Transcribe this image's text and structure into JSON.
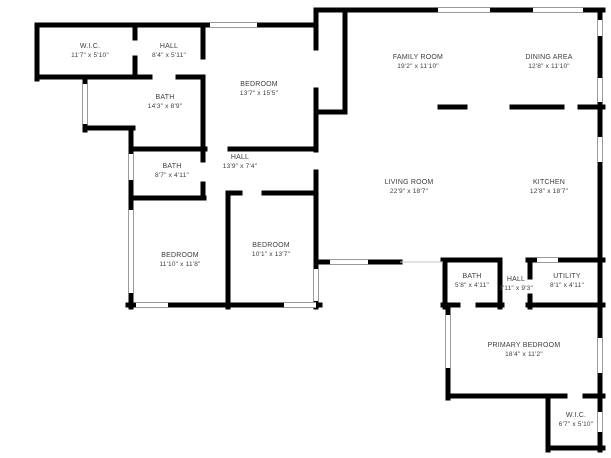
{
  "canvas": {
    "width": 611,
    "height": 458,
    "background": "#ffffff",
    "wall_color": "#000000",
    "window_edge_color": "#9a9a9a",
    "opening_color": "#c8c8c8",
    "text_color": "#3d3d3d",
    "wall_thickness": 5
  },
  "rooms": [
    {
      "id": "wic-top",
      "name": "W.I.C.",
      "dims": "11'7\" x 5'10\"",
      "cx": 90,
      "cy": 48
    },
    {
      "id": "hall-top",
      "name": "HALL",
      "dims": "8'4\" x 5'11\"",
      "cx": 169,
      "cy": 48
    },
    {
      "id": "bath-large",
      "name": "BATH",
      "dims": "14'3\" x 8'9\"",
      "cx": 165,
      "cy": 99
    },
    {
      "id": "bedroom-top",
      "name": "BEDROOM",
      "dims": "13'7\" x 15'5\"",
      "cx": 259,
      "cy": 86
    },
    {
      "id": "family-room",
      "name": "FAMILY ROOM",
      "dims": "19'2\" x 11'10\"",
      "cx": 418,
      "cy": 59
    },
    {
      "id": "dining-area",
      "name": "DINING AREA",
      "dims": "12'8\" x 11'10\"",
      "cx": 549,
      "cy": 59
    },
    {
      "id": "living-room",
      "name": "LIVING ROOM",
      "dims": "22'9\" x 18'7\"",
      "cx": 409,
      "cy": 184
    },
    {
      "id": "kitchen",
      "name": "KITCHEN",
      "dims": "12'8\" x 18'7\"",
      "cx": 549,
      "cy": 184
    },
    {
      "id": "bath-mid",
      "name": "BATH",
      "dims": "8'7\" x 4'11\"",
      "cx": 172,
      "cy": 168
    },
    {
      "id": "hall-mid",
      "name": "HALL",
      "dims": "13'9\" x 7'4\"",
      "cx": 240,
      "cy": 159
    },
    {
      "id": "bedroom-left",
      "name": "BEDROOM",
      "dims": "11'10\" x 11'8\"",
      "cx": 180,
      "cy": 257
    },
    {
      "id": "bedroom-mid",
      "name": "BEDROOM",
      "dims": "10'1\" x 13'7\"",
      "cx": 271,
      "cy": 247
    },
    {
      "id": "bath-small",
      "name": "BATH",
      "dims": "5'8\" x 4'11\"",
      "cx": 472,
      "cy": 278
    },
    {
      "id": "hall-small",
      "name": "HALL",
      "dims": "3'11\" x 9'3\"",
      "cx": 516,
      "cy": 281
    },
    {
      "id": "utility",
      "name": "UTILITY",
      "dims": "8'1\" x 4'11\"",
      "cx": 567,
      "cy": 278
    },
    {
      "id": "primary-bedroom",
      "name": "PRIMARY BEDROOM",
      "dims": "18'4\" x 11'2\"",
      "cx": 524,
      "cy": 347
    },
    {
      "id": "wic-bottom",
      "name": "W.I.C.",
      "dims": "6'7\" x 5'10\"",
      "cx": 576,
      "cy": 417
    }
  ],
  "walls": [
    [
      37,
      25,
      316,
      25
    ],
    [
      316,
      10,
      603,
      10
    ],
    [
      316,
      10,
      316,
      27
    ],
    [
      37,
      25,
      37,
      79
    ],
    [
      37,
      77,
      150,
      77
    ],
    [
      178,
      77,
      203,
      77
    ],
    [
      135,
      25,
      135,
      38
    ],
    [
      135,
      58,
      135,
      77
    ],
    [
      203,
      25,
      203,
      57
    ],
    [
      203,
      80,
      203,
      151
    ],
    [
      85,
      77,
      85,
      130
    ],
    [
      85,
      128,
      133,
      128
    ],
    [
      131,
      128,
      131,
      151
    ],
    [
      131,
      149,
      205,
      149
    ],
    [
      230,
      149,
      316,
      149
    ],
    [
      131,
      151,
      131,
      307
    ],
    [
      203,
      149,
      203,
      160
    ],
    [
      203,
      184,
      203,
      198
    ],
    [
      131,
      198,
      204,
      198
    ],
    [
      228,
      193,
      240,
      193
    ],
    [
      264,
      193,
      316,
      193
    ],
    [
      228,
      193,
      228,
      307
    ],
    [
      128,
      305,
      320,
      305
    ],
    [
      316,
      25,
      316,
      48
    ],
    [
      316,
      90,
      316,
      150
    ],
    [
      316,
      172,
      316,
      307
    ],
    [
      316,
      112,
      345,
      112
    ],
    [
      345,
      10,
      345,
      112
    ],
    [
      600,
      10,
      600,
      260
    ],
    [
      440,
      107,
      465,
      107
    ],
    [
      512,
      107,
      562,
      107
    ],
    [
      580,
      107,
      603,
      107
    ],
    [
      316,
      262,
      400,
      262
    ],
    [
      443,
      260,
      500,
      260
    ],
    [
      528,
      260,
      603,
      260
    ],
    [
      445,
      260,
      445,
      307
    ],
    [
      500,
      260,
      500,
      307
    ],
    [
      530,
      260,
      530,
      277
    ],
    [
      530,
      296,
      530,
      307
    ],
    [
      443,
      305,
      458,
      305
    ],
    [
      478,
      305,
      502,
      305
    ],
    [
      528,
      305,
      603,
      305
    ],
    [
      448,
      305,
      448,
      398
    ],
    [
      600,
      260,
      600,
      450
    ],
    [
      448,
      396,
      548,
      396
    ],
    [
      548,
      396,
      565,
      396
    ],
    [
      585,
      396,
      603,
      396
    ],
    [
      548,
      396,
      548,
      450
    ],
    [
      548,
      448,
      603,
      448
    ]
  ],
  "windows": [
    [
      210,
      25,
      257,
      25
    ],
    [
      438,
      10,
      490,
      10
    ],
    [
      533,
      10,
      583,
      10
    ],
    [
      600,
      20,
      600,
      36
    ],
    [
      600,
      78,
      600,
      102
    ],
    [
      600,
      137,
      600,
      162
    ],
    [
      85,
      84,
      85,
      124
    ],
    [
      131,
      154,
      131,
      180
    ],
    [
      131,
      210,
      131,
      293
    ],
    [
      136,
      305,
      168,
      305
    ],
    [
      284,
      305,
      316,
      305
    ],
    [
      316,
      269,
      316,
      301
    ],
    [
      330,
      262,
      368,
      262
    ],
    [
      537,
      260,
      558,
      260
    ],
    [
      448,
      315,
      448,
      368
    ],
    [
      600,
      338,
      600,
      373
    ],
    [
      600,
      412,
      600,
      432
    ]
  ],
  "openings": [
    [
      400,
      262,
      443,
      262
    ]
  ]
}
